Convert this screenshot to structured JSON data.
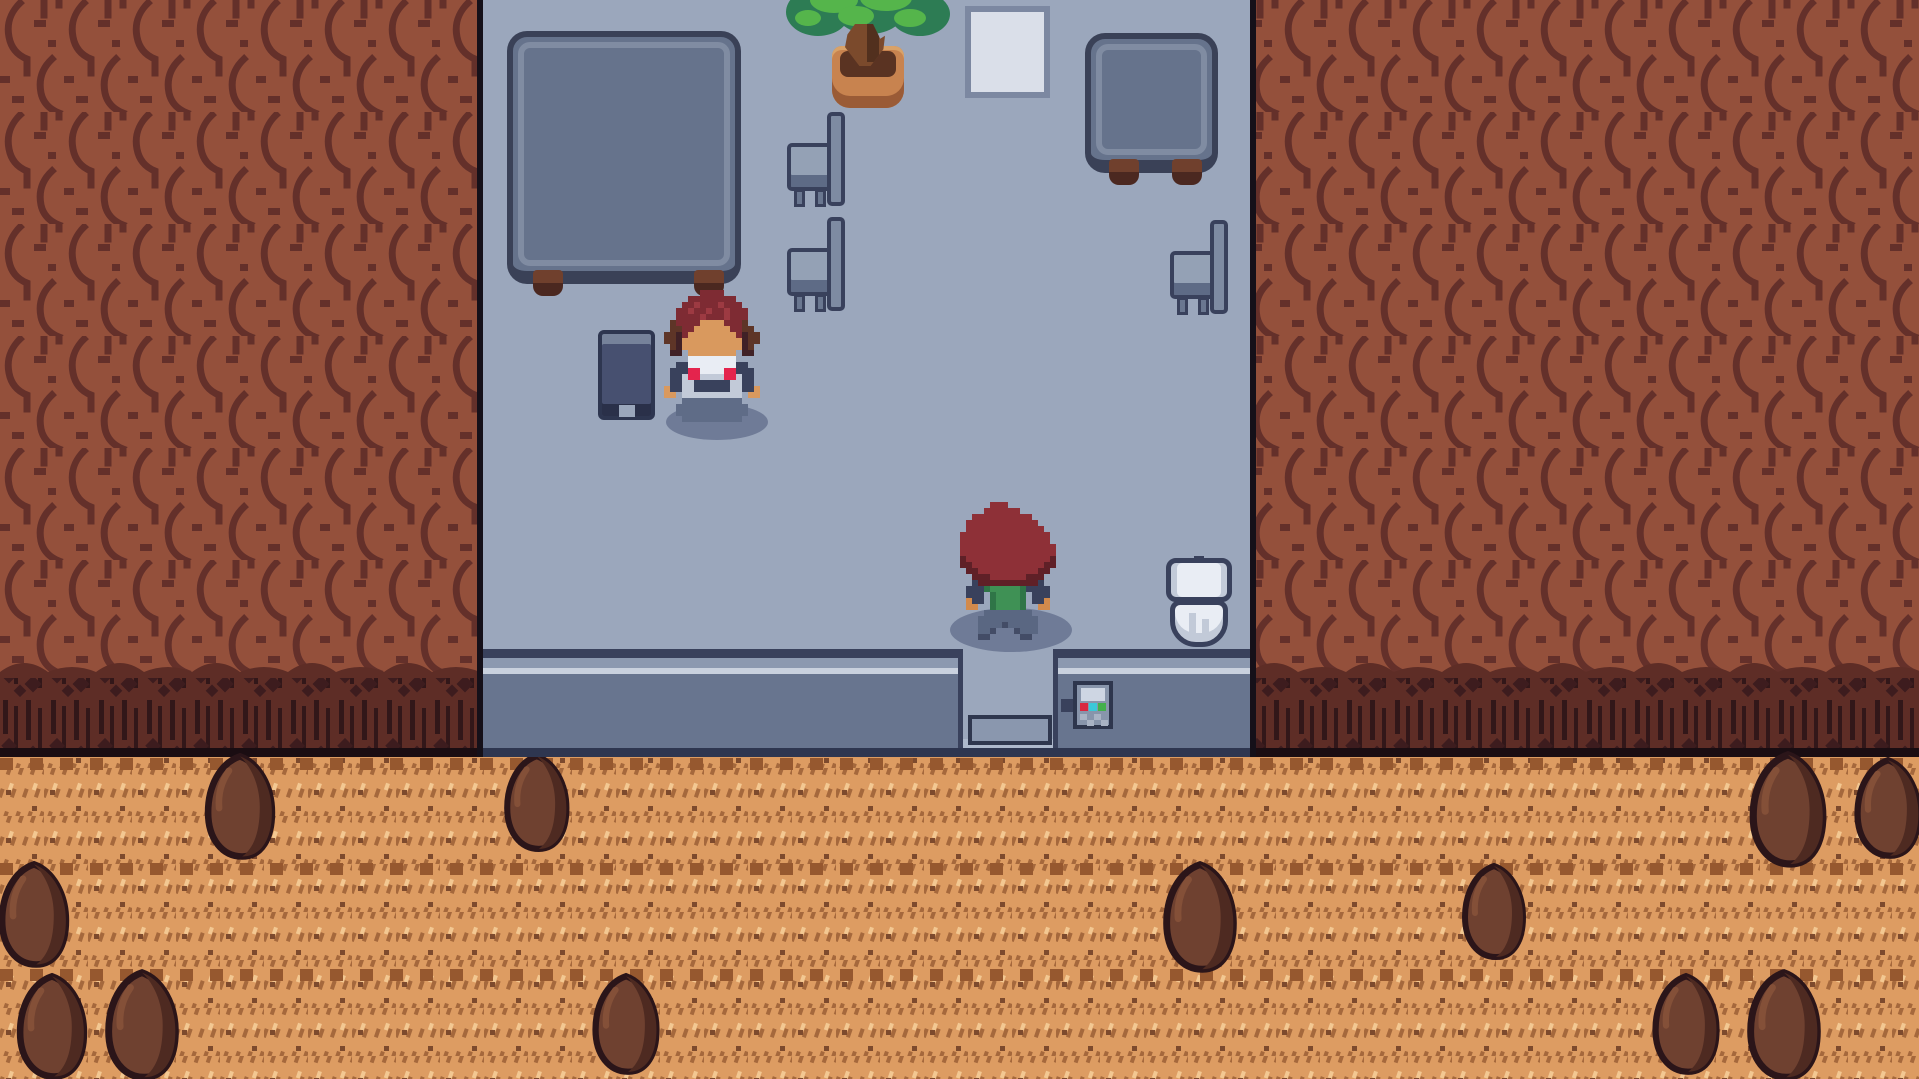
{
  "scene": {
    "kind": "top-down pixel-art RPG screenshot",
    "visible_text": [],
    "regions": {
      "left_cliff": "rocky red-brown cliff wall",
      "right_cliff": "rocky red-brown cliff wall",
      "room": "building interior with blue-gray floor, open at top",
      "doorway": "south exit with doormat",
      "dirt_path": "orange hatched dirt trail with boulders"
    }
  },
  "palette": {
    "floor": "#9BA7BC",
    "wall_outline": "#39415C",
    "wall_band": "#8C99B0",
    "wall_highlight": "#C9D1DE",
    "wall_face": "#68758F",
    "wall_base": "#2E3650",
    "cliff_base": "#94503B",
    "cliff_crack": "#64302A",
    "cliff_fringe": "#5E2D26",
    "fringe_streak": "#321719",
    "edge_line": "#151019",
    "dirt_base": "#DD9C62",
    "dirt_dark": "#A5683C",
    "dirt_light": "#F3C892",
    "dirt_speck": "#7D4A2D",
    "boulder_body": "#6F4130",
    "boulder_shade": "#4E2A21",
    "boulder_outline": "#2B1519",
    "furniture_fill": "#66738C",
    "furniture_outline": "#3A4157",
    "furniture_highlight": "#808CA2",
    "wood_foot": "#70402D",
    "plant_leaf_dark": "#2D7C54",
    "plant_leaf_light": "#55B54B",
    "pot_clay": "#C8834F",
    "poster_fill": "#DADFE9",
    "porcelain": "#E9EDF4",
    "panel_red": "#D82840",
    "panel_cyan": "#3AC8D8",
    "panel_green": "#43B04C"
  },
  "objects": [
    {
      "id": "table-large",
      "label": "large square table"
    },
    {
      "id": "table-small",
      "label": "small square table"
    },
    {
      "id": "chair-left-upper",
      "label": "chair facing left"
    },
    {
      "id": "chair-left-lower",
      "label": "chair facing left"
    },
    {
      "id": "chair-right",
      "label": "chair facing left"
    },
    {
      "id": "chair-front",
      "label": "chair seen from front"
    },
    {
      "id": "potted-plant",
      "label": "potted tree"
    },
    {
      "id": "poster",
      "label": "blank wall poster"
    },
    {
      "id": "toilet",
      "label": "toilet seen from above"
    },
    {
      "id": "wall-panel",
      "label": "small wall device with red/cyan/green squares"
    },
    {
      "id": "door-mat",
      "label": "doormat at south exit"
    },
    {
      "id": "boulders",
      "label": "12 boulders on the dirt path"
    }
  ],
  "characters": [
    {
      "id": "npc-attendant",
      "facing": "south",
      "hair": "dark red with brown side curls",
      "outfit": "white shirt, navy vest, red bow, blue-gray skirt"
    },
    {
      "id": "player",
      "facing": "south",
      "hair": "red",
      "outfit": "green shirt, navy jacket, blue-gray pants"
    }
  ],
  "sprites": {
    "npc": {
      "pixel_size": 6,
      "palette": {
        "R": "#7E2B33",
        "L": "#9D3A42",
        "B": "#5E3527",
        "b": "#402126",
        "S": "#D9995E",
        "W": "#E9EDF4",
        "w": "#C2CAD8",
        "N": "#39415C",
        "K": "#E4244D",
        "P": "#5F6C87"
      },
      "grid": [
        "......RRRR.......",
        "....RRRRRRRR.....",
        "...RRLRRRLRRR....",
        "..RRLRRLRRLRRR...",
        "..RRRRLRRRLRRR...",
        ".BRRRRSSSSRRRB...",
        ".BBRRSSSSSSRRBB..",
        "BBbRSSSSSSSSRbBB.",
        "BBbSSSSSSSSSSbBB.",
        ".BbSSSSSSSSSSbB..",
        ".bb.SSSSSSSS.bb..",
        "....WWWWWWWW.....",
        "..NNWWWWWWWWNN...",
        ".NNNKKWWWWKKNNN..",
        ".NNwKKwwwwKKwNN..",
        ".NNwwNNNNNNwwNN..",
        "SNNwwNNNNNNwwNNS.",
        "SS.wwwwwwwwww.SS.",
        "...PPPPPPPPPP....",
        "..PPPPPPPPPPPP...",
        "..PPPPPPPPPPPP...",
        "...PPPPPPPPPP...."
      ]
    },
    "player": {
      "pixel_size": 6,
      "palette": {
        "R": "#8E3037",
        "r": "#5F2027",
        "N": "#39415C",
        "G": "#3F9155",
        "g": "#2F7547",
        "S": "#D28A4C",
        "P": "#5A6782",
        "p": "#434C66"
      },
      "grid": [
        ".....RRR.........",
        "....RRRRRR.......",
        "..RRRRRRRRRR.....",
        ".RRRRRRRRRRRR....",
        ".RRRRRRRRRRRRR...",
        "RRRRRRRRRRRRRRR..",
        "RRRRRRRRRRRRRRR..",
        "RRRRRRRRRRRRRRRR.",
        "RRRRRRRRRRRRRRRR.",
        "rRRRRRRRRRRRRRRr.",
        "rrRRRRRRRRRRRRrr.",
        ".rrRRRRRRRRRRrr..",
        "..rrrRRRRRRrrr...",
        "..NrrrrrrrrrrN...",
        ".NNNgGGGGGgNNNN..",
        ".NNN.gGGGGg.NNN..",
        ".SNN.gGGGGg.NNS..",
        ".SS..gGGGGg..SS..",
        "....PPPPPPPP.....",
        "...PPPPPPPPPP....",
        "...PPPPpPPPPP....",
        "...PPp...pPPP....",
        "...pp.....pp....."
      ]
    }
  }
}
